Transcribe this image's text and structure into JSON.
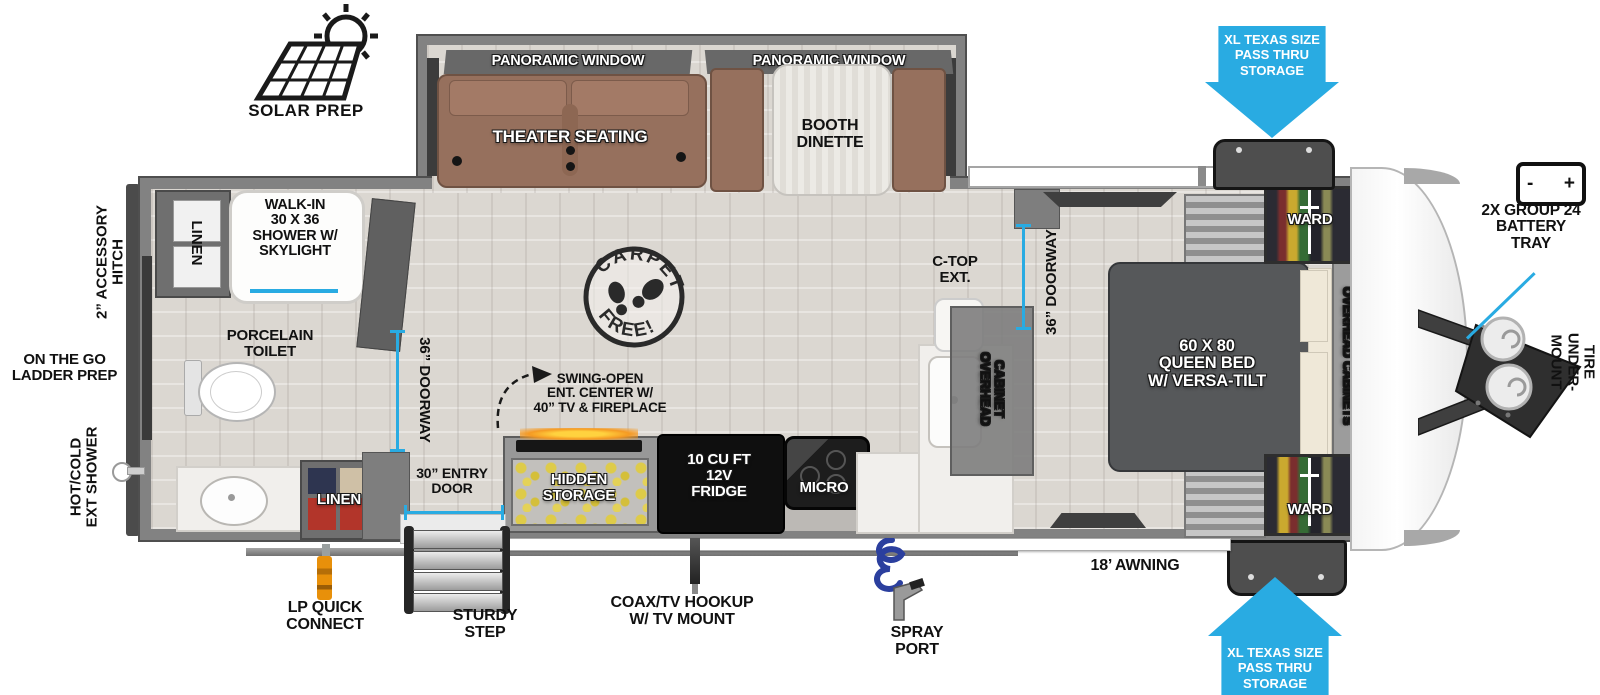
{
  "colors": {
    "accent_blue": "#29ABE2",
    "wall_gray": "#7E7E7E",
    "floor": "#DBD7D1",
    "sofa_brown": "#96705D",
    "bed_gray": "#56585A",
    "fridge_black": "#0F0F0F",
    "coil_blue": "#2B3F9E",
    "lp_orange": "#E8900A"
  },
  "exterior_left": {
    "solar_prep": "SOLAR PREP",
    "accessory_hitch": "2” ACCESSORY\nHITCH",
    "ladder_prep": "ON THE GO\nLADDER PREP",
    "ext_shower": "HOT/COLD\nEXT SHOWER"
  },
  "exterior_right": {
    "battery_icon_minus": "-",
    "battery_icon_plus": "+",
    "battery_tray": "2X GROUP 24\nBATTERY\nTRAY",
    "spare_tire_line1": "UNDER-MOUNT",
    "spare_tire_line2": "SPARE TIRE"
  },
  "exterior_bottom": {
    "lp_quick_connect": "LP QUICK\nCONNECT",
    "sturdy_step": "STURDY\nSTEP",
    "entry_door": "30” ENTRY\nDOOR",
    "coax_tv": "COAX/TV HOOKUP\nW/ TV MOUNT",
    "spray_port": "SPRAY\nPORT",
    "awning": "18’ AWNING"
  },
  "storage": {
    "top_arrow": "XL TEXAS SIZE\nPASS THRU\nSTORAGE",
    "bottom_arrow": "XL TEXAS SIZE\nPASS THRU\nSTORAGE"
  },
  "slide_out": {
    "window_left": "PANORAMIC WINDOW",
    "window_right": "PANORAMIC WINDOW",
    "theater_seating": "THEATER SEATING",
    "booth_dinette": "BOOTH\nDINETTE"
  },
  "bathroom": {
    "linen_top": "LINEN",
    "shower": "WALK-IN\n30 X 36\nSHOWER W/\nSKYLIGHT",
    "toilet": "PORCELAIN\nTOILET",
    "doorway": "36” DOORWAY",
    "linen_bottom": "LINEN"
  },
  "kitchen": {
    "swing_open": "SWING-OPEN\nENT. CENTER W/\n40” TV & FIREPLACE",
    "hidden_storage": "HIDDEN\nSTORAGE",
    "fridge": "10 CU FT\n12V\nFRIDGE",
    "micro": "MICRO",
    "ctop_ext": "C-TOP\nEXT.",
    "overhead_line1": "OVERHEAD",
    "overhead_line2": "CABINET",
    "doorway": "36” DOORWAY"
  },
  "bedroom": {
    "bed": "60 X  80\nQUEEN BED\nW/ VERSA-TILT",
    "ward_top": "WARD",
    "ward_bottom": "WARD",
    "overhead_cabinets": "OVERHEAD CABINETS"
  },
  "stamp": {
    "arc_top": "CARPET",
    "arc_bottom": "FREE!"
  }
}
